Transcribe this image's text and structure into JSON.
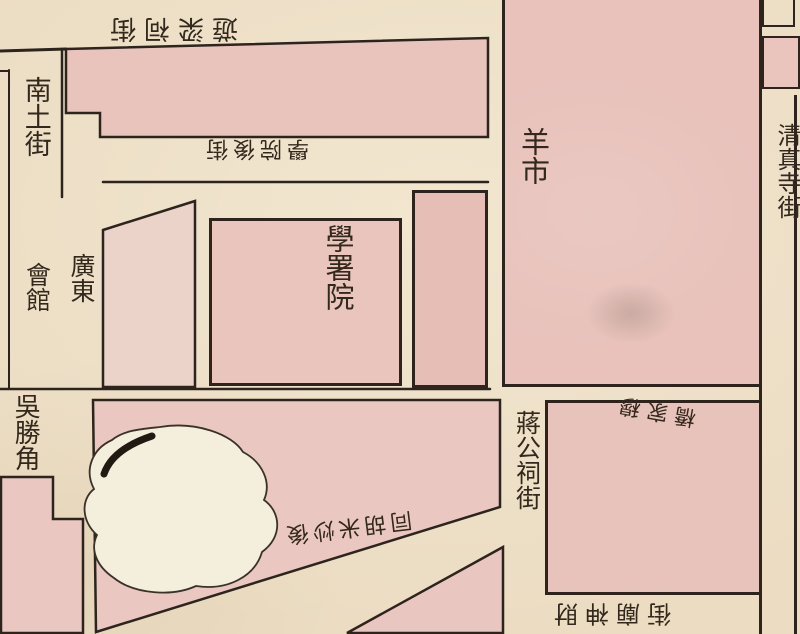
{
  "map": {
    "labels": {
      "top_street": {
        "text": "遊梁祠街"
      },
      "south_street": {
        "text": "南土街"
      },
      "academy_back_street): ": null,
      "academy_back_street": {
        "text": "學院後街"
      },
      "sheep_market": {
        "text": "羊市"
      },
      "mosque_street": {
        "text": "清真寺街"
      },
      "academy_office": {
        "text": "學署院"
      },
      "guild_hall_right_column": {
        "text": "廣東"
      },
      "guild_hall_left_column": {
        "text": "會館"
      },
      "wusheng_corner": {
        "text": "吳勝角"
      },
      "mu_family_bridge": {
        "text": "穆家橋"
      },
      "jiang_shrine_street": {
        "text": "蔣公祠街"
      },
      "rear_hutong": {
        "text": "後炒米胡同"
      },
      "temple_street": {
        "text": "財神廟街"
      }
    },
    "colors": {
      "paper": "#ebdcc2",
      "block_pink": "#e9c5be",
      "block_deep_pink": "#e6beb5",
      "block_pale": "#ecd3c9",
      "pond": "#f4eedd",
      "line_ink": "#2c241d",
      "text_ink": "#33281c"
    }
  }
}
